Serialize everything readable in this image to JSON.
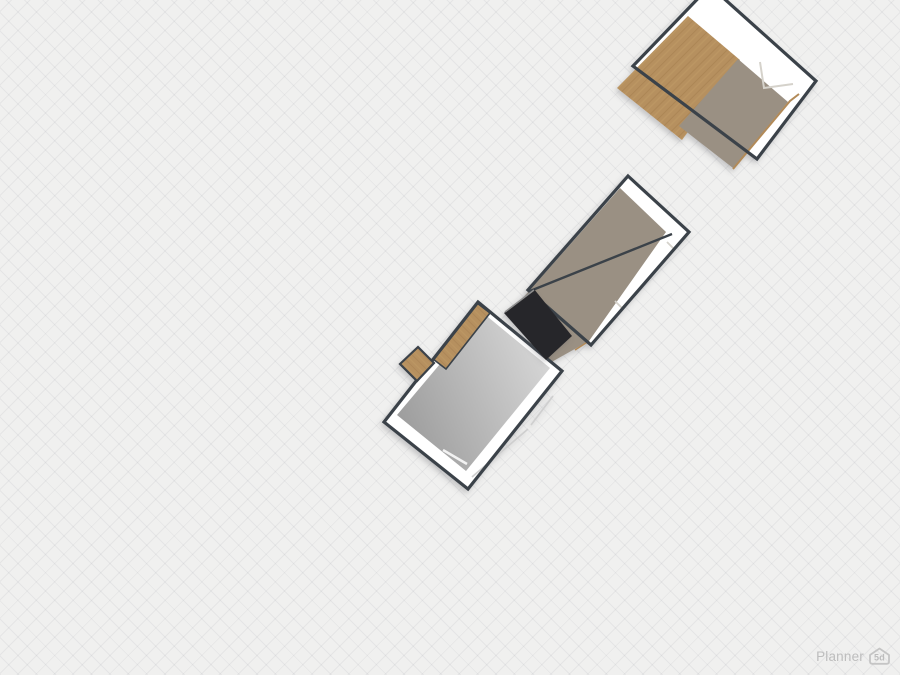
{
  "watermark": {
    "text": "Planner",
    "badge": "5d"
  },
  "canvas": {
    "width": 900,
    "height": 675,
    "background": "#f0f0ef",
    "grid": {
      "spacing": 13,
      "line_color": "rgba(130,133,145,0.10)"
    }
  },
  "colors": {
    "wall_outline": "#3b4249",
    "wall_white": "#ffffff",
    "wood": "#b6905f",
    "wood_plank_line": "#a17c4e",
    "wood_plank_light": "#c7a06b",
    "taupe_floor": "#9a9083",
    "gray_floor_dark": "#9c9c9c",
    "gray_floor_light": "#d8d8d8",
    "black_item": "#28282b",
    "black_item_highlight": "#8e8e8e",
    "floor_edge_tan": "#b28a58",
    "wall_detail_line": "#d5d2cb",
    "window_line": "#cfcfcf",
    "door_line": "#f2f2f2"
  },
  "scene": {
    "rooms": [
      {
        "id": "room-top-right",
        "shadow": true,
        "shapes": [
          {
            "type": "polygon",
            "name": "wall-interior",
            "points": "710,-14 816,81 757,159 633,66",
            "fill": "#ffffff"
          },
          {
            "type": "polygon",
            "name": "wood-floor",
            "points": "688,16 740,60 682,140 617,88",
            "fill": "url(#woodPattern)"
          },
          {
            "type": "polygon",
            "name": "taupe-floor",
            "points": "738,59 788,102 733,168 679,126",
            "fill": "#9a9083"
          },
          {
            "type": "polyline",
            "name": "floor-edge-line",
            "points": "733,169 790,101 799,94",
            "stroke": "#b28a58",
            "width": 2
          },
          {
            "type": "polyline",
            "name": "wall-detail-line",
            "points": "760,62 764,88 793,84",
            "stroke": "#d5d2cb",
            "width": 2
          },
          {
            "type": "polygon",
            "name": "wall-outline",
            "points": "710,-14 816,81 757,159 633,66",
            "stroke": "#3b4249",
            "width": 3.2
          }
        ]
      },
      {
        "id": "room-middle",
        "shadow": true,
        "shapes": [
          {
            "type": "polygon",
            "name": "wall-interior",
            "points": "628,176 689,232 591,345 528,290",
            "fill": "#ffffff"
          },
          {
            "type": "polygon",
            "name": "taupe-floor",
            "points": "620,188 666,232 589,341 548,364 514,308",
            "fill": "#9a9083"
          },
          {
            "type": "polyline",
            "name": "divider-wall",
            "points": "530,291 672,234",
            "stroke": "#3b4249",
            "width": 2.4
          },
          {
            "type": "polyline",
            "name": "window-line",
            "points": "667,242 674,249 622,308 615,301",
            "stroke": "#d5d2cb",
            "width": 1.8
          },
          {
            "type": "polyline",
            "name": "floor-edge-line",
            "points": "575,350 589,341",
            "stroke": "#b28a58",
            "width": 1.5
          },
          {
            "type": "polygon",
            "name": "wall-outline",
            "points": "628,176 689,232 591,345 528,290",
            "stroke": "#3b4249",
            "width": 3.2
          }
        ]
      },
      {
        "id": "room-bottom-left",
        "shadow": true,
        "shapes": [
          {
            "type": "polygon",
            "name": "wall-interior",
            "points": "478,302 562,371 468,489 384,422",
            "fill": "#ffffff"
          },
          {
            "type": "polygon",
            "name": "gray-floor",
            "points": "483,313 550,368 466,471 397,415",
            "fill": "url(#grayFloorGrad)"
          },
          {
            "type": "polyline",
            "name": "door-line",
            "points": "443,450 467,464",
            "stroke": "#f2f2f2",
            "width": 2.5
          },
          {
            "type": "polyline",
            "name": "window-line",
            "points": "472,477 528,429",
            "stroke": "#cfcfcf",
            "width": 1.8
          },
          {
            "type": "polyline",
            "name": "window-line",
            "points": "531,425 553,396",
            "stroke": "#cfcfcf",
            "width": 1.8
          },
          {
            "type": "polygon",
            "name": "wood-shelf-strip",
            "points": "477,303 490,313 446,369 433,359",
            "fill": "url(#woodPattern2)",
            "stroke": "#3b4249",
            "width": 1.6
          },
          {
            "type": "polygon",
            "name": "wall-outline",
            "points": "478,302 562,371 468,489 384,422",
            "stroke": "#3b4249",
            "width": 3.2
          },
          {
            "type": "polygon",
            "name": "wood-box",
            "points": "418,347 434,363 417,381 400,364",
            "fill": "url(#woodPattern2)",
            "stroke": "#3b4249",
            "width": 2.2
          }
        ]
      },
      {
        "id": "black-counter-item",
        "shadow": true,
        "shapes": [
          {
            "type": "polygon",
            "name": "black-counter",
            "points": "504,313 534,289 572,336 546,360",
            "fill": "#28282b"
          },
          {
            "type": "polyline",
            "name": "black-counter-highlight",
            "points": "505,312 534,290",
            "stroke": "#8e8e8e",
            "width": 1.6
          }
        ]
      }
    ]
  }
}
